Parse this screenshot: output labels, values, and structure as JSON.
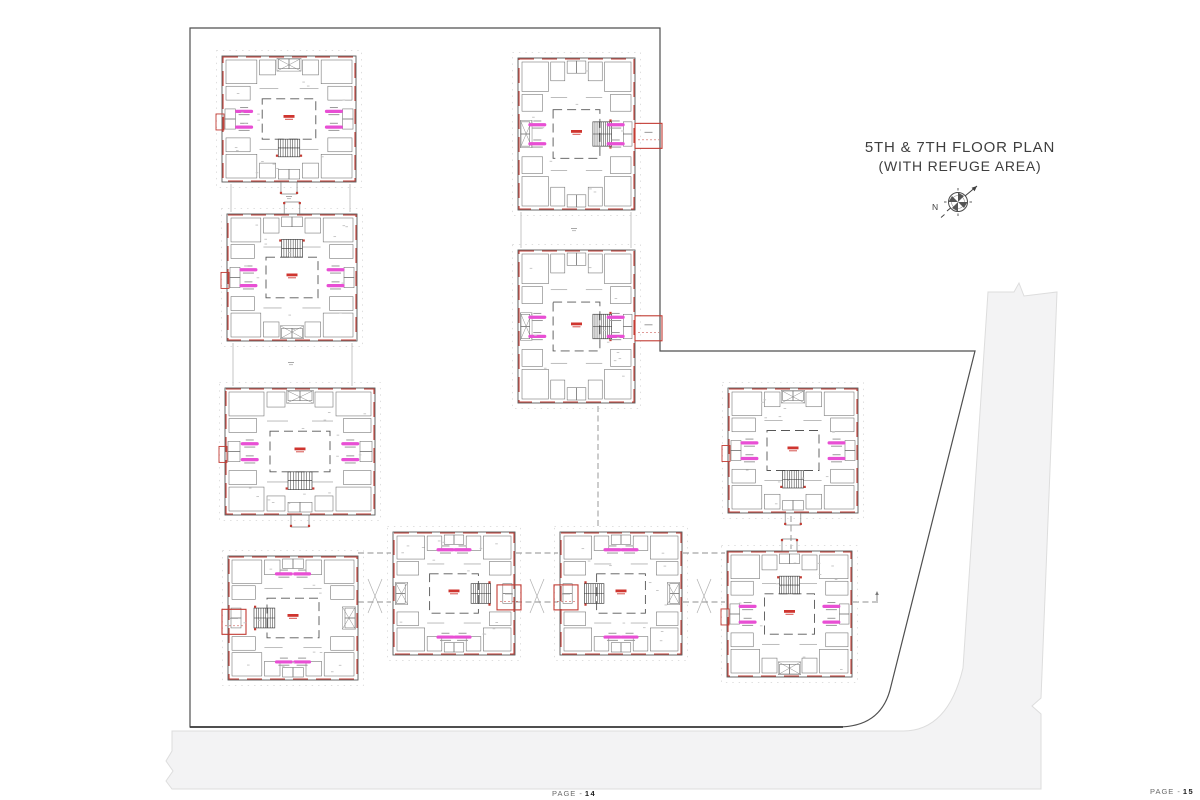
{
  "title": {
    "line1": "5TH & 7TH FLOOR PLAN",
    "line2": "(WITH REFUGE AREA)"
  },
  "compass": {
    "label": "N"
  },
  "footer": {
    "left": {
      "prefix": "PAGE -",
      "number": "14"
    },
    "right": {
      "prefix": "PAGE -",
      "number": "15"
    }
  },
  "drawing": {
    "canvas": {
      "w": 1200,
      "h": 800
    },
    "colors": {
      "road_fill": "#f3f3f4",
      "road_edge": "#dddddd",
      "boundary": "#4f4f4f",
      "wall_gray": "#5a5a5a",
      "room_gray": "#6e6e6e",
      "wall_red": "#c23b33",
      "unit_label_pink": "#e84fd4",
      "center_label_red": "#cf352f",
      "dash_gray": "#8f8f8f",
      "compound_gray": "#c6c6c6",
      "speck_gray": "#c2c2c2"
    },
    "roads_path": "M988,292 L1014,292 L1019,283 L1024,296 L1057,292 L1041,698 L1032,706 L1041,714 L1041,789 L172,789 L166,781 L173,771 L166,761 L172,751 L172,731 L903,731 Q948,731 963,668 Z",
    "boundary_path": "M190,28 L660,28 L660,351 L975,351 L890,690 Q880,727 838,727 L190,727 Z",
    "boundary_bottom": [
      190,
      727,
      843,
      727
    ],
    "compound_walls": [
      [
        231,
        184,
        231,
        212
      ],
      [
        350,
        184,
        350,
        212
      ],
      [
        233,
        343,
        233,
        386
      ],
      [
        352,
        343,
        352,
        386
      ],
      [
        521,
        212,
        521,
        248
      ],
      [
        631,
        212,
        631,
        248
      ]
    ],
    "gap_marks": [
      [
        289,
        196
      ],
      [
        291,
        362
      ],
      [
        574,
        228
      ]
    ],
    "gap_crosses": [
      [
        375,
        596
      ],
      [
        537,
        596
      ],
      [
        704,
        596
      ]
    ],
    "dashed_links": [
      [
        358,
        553,
        391,
        553
      ],
      [
        516,
        553,
        558,
        553
      ],
      [
        683,
        553,
        725,
        553
      ],
      [
        358,
        602,
        391,
        602
      ],
      [
        516,
        602,
        558,
        602
      ],
      [
        683,
        602,
        725,
        602
      ],
      [
        853,
        602,
        879,
        602
      ],
      [
        598,
        406,
        598,
        529
      ],
      [
        791,
        516,
        791,
        549
      ]
    ],
    "north_tick": [
      877,
      593
    ],
    "blocks": [
      {
        "id": 1,
        "x": 222,
        "y": 56,
        "w": 134,
        "h": 126,
        "stair": "bottom",
        "labels": "lr",
        "refugeMini": true
      },
      {
        "id": 2,
        "x": 227,
        "y": 214,
        "w": 130,
        "h": 127,
        "stair": "top",
        "labels": "lr",
        "refugeMini": true
      },
      {
        "id": 3,
        "x": 225,
        "y": 388,
        "w": 150,
        "h": 127,
        "stair": "bottom",
        "labels": "lr",
        "refugeMini": true
      },
      {
        "id": 4,
        "x": 518,
        "y": 58,
        "w": 117,
        "h": 152,
        "stair": "right",
        "labels": "lr",
        "refuge": "right",
        "out": 27
      },
      {
        "id": 5,
        "x": 518,
        "y": 250,
        "w": 117,
        "h": 153,
        "stair": "right",
        "labels": "lr",
        "refuge": "right",
        "out": 27
      },
      {
        "id": 6,
        "x": 728,
        "y": 388,
        "w": 130,
        "h": 125,
        "stair": "bottom",
        "labels": "lr",
        "refugeMini": true
      },
      {
        "id": 7,
        "x": 228,
        "y": 556,
        "w": 130,
        "h": 124,
        "stair": "left",
        "labels": "tb",
        "refuge": "left",
        "out": 6
      },
      {
        "id": 8,
        "x": 393,
        "y": 532,
        "w": 122,
        "h": 123,
        "stair": "right",
        "labels": "tb",
        "refuge": "right",
        "out": 6
      },
      {
        "id": 9,
        "x": 560,
        "y": 532,
        "w": 122,
        "h": 123,
        "stair": "left",
        "labels": "tb",
        "refuge": "left",
        "out": 6
      },
      {
        "id": 10,
        "x": 727,
        "y": 551,
        "w": 125,
        "h": 126,
        "stair": "top",
        "labels": "lr",
        "refugeMini": true
      }
    ]
  }
}
